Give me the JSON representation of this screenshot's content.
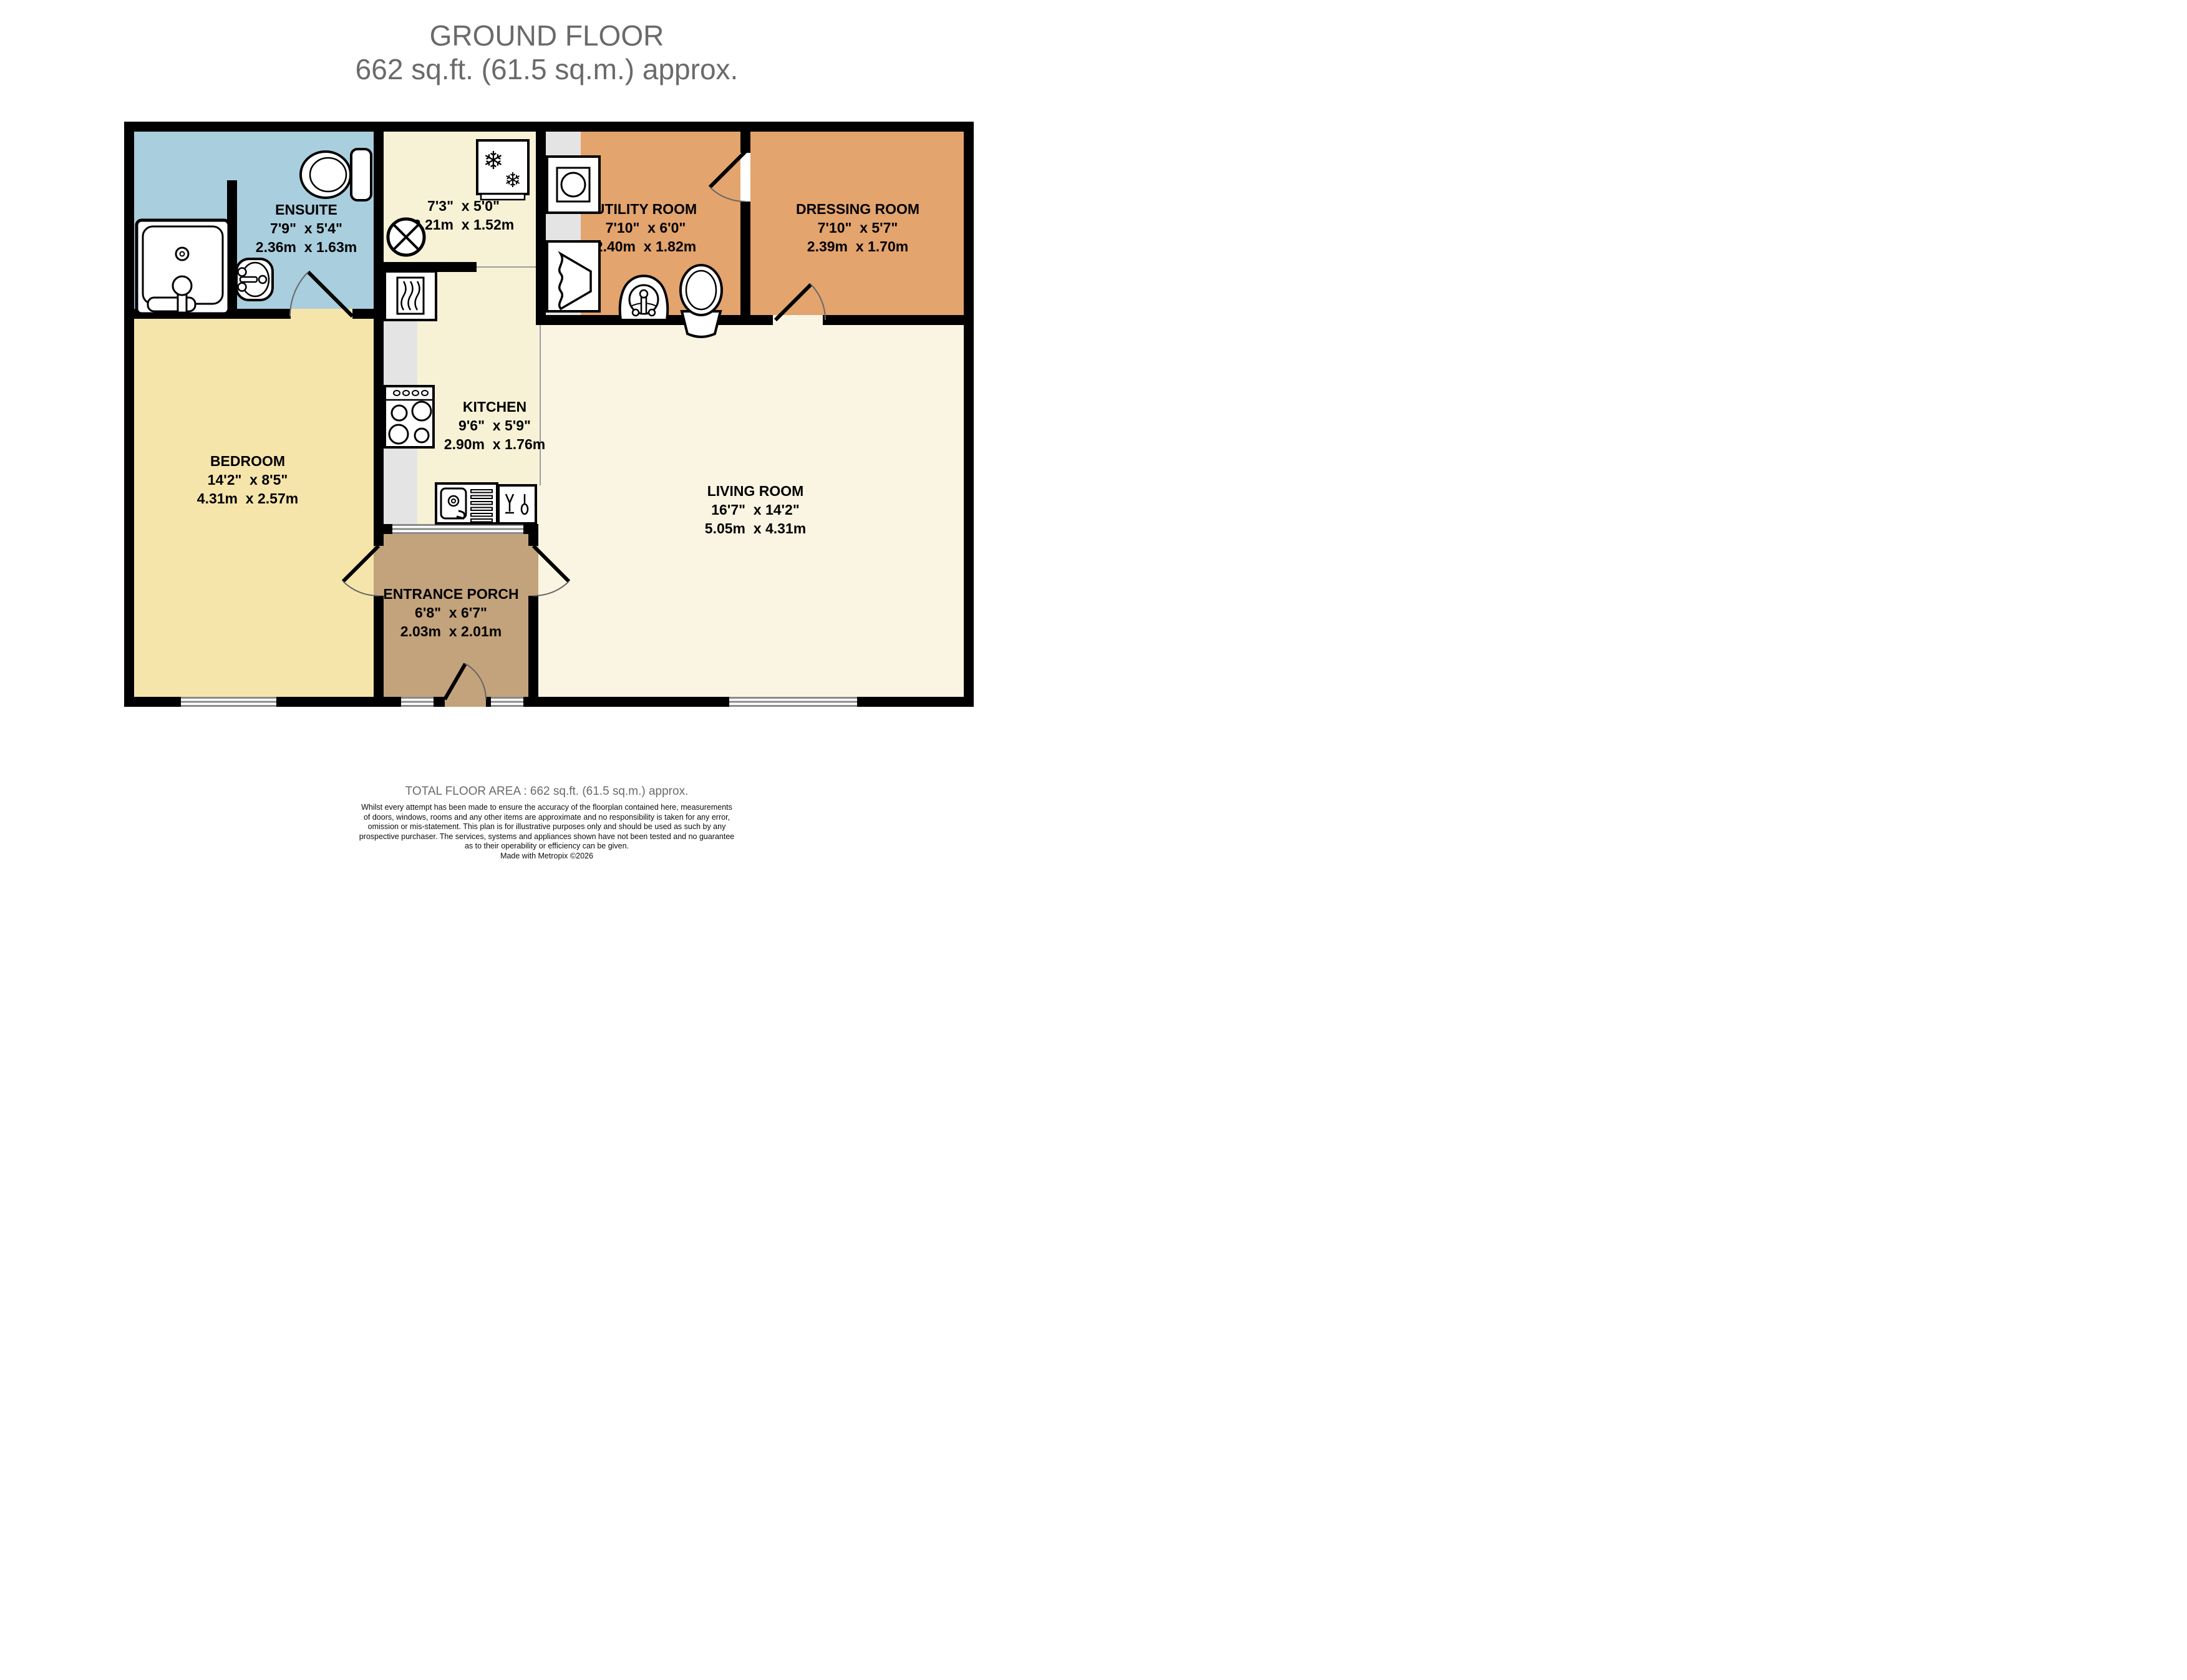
{
  "title": {
    "line1": "GROUND FLOOR",
    "line2": "662 sq.ft. (61.5 sq.m.) approx."
  },
  "rooms": {
    "ensuite": {
      "name": "ENSUITE",
      "imperial": "7'9\"  x 5'4\"",
      "metric": "2.36m  x 1.63m"
    },
    "hallway": {
      "imperial": "7'3\"  x 5'0\"",
      "metric": "2.21m  x 1.52m"
    },
    "utility": {
      "name": "UTILITY ROOM",
      "imperial": "7'10\"  x 6'0\"",
      "metric": "2.40m  x 1.82m"
    },
    "dressing": {
      "name": "DRESSING ROOM",
      "imperial": "7'10\"  x 5'7\"",
      "metric": "2.39m  x 1.70m"
    },
    "bedroom": {
      "name": "BEDROOM",
      "imperial": "14'2\"  x 8'5\"",
      "metric": "4.31m  x 2.57m"
    },
    "kitchen": {
      "name": "KITCHEN",
      "imperial": "9'6\"  x 5'9\"",
      "metric": "2.90m  x 1.76m"
    },
    "living": {
      "name": "LIVING ROOM",
      "imperial": "16'7\"  x 14'2\"",
      "metric": "5.05m  x 4.31m"
    },
    "porch": {
      "name": "ENTRANCE PORCH",
      "imperial": "6'8\"  x 6'7\"",
      "metric": "2.03m  x 2.01m"
    }
  },
  "footer": {
    "total": "TOTAL FLOOR AREA : 662 sq.ft. (61.5 sq.m.) approx.",
    "disclaimer1": "Whilst every attempt has been made to ensure the accuracy of the floorplan contained here, measurements",
    "disclaimer2": "of doors, windows, rooms and any other items are approximate and no responsibility is taken for any error,",
    "disclaimer3": "omission or mis-statement. This plan is for illustrative purposes only and should be used as such by any",
    "disclaimer4": "prospective purchaser. The services, systems and appliances shown have not been tested and no guarantee",
    "disclaimer5": "as to their operability or efficiency can be given.",
    "credit": "Made with Metropix ©2026"
  },
  "icons": {
    "snowflake": "❄"
  },
  "colors": {
    "wall": "#000000",
    "ensuite": "#a9cede",
    "bedroom": "#f6e5ab",
    "kitchen_hall": "#f7f2d6",
    "living": "#f9f5e2",
    "utility_dressing": "#e3a46e",
    "porch": "#c3a37b",
    "counter": "#e4e4e4",
    "window_line": "#8a8a8a",
    "title_text": "#6a6a6a"
  }
}
